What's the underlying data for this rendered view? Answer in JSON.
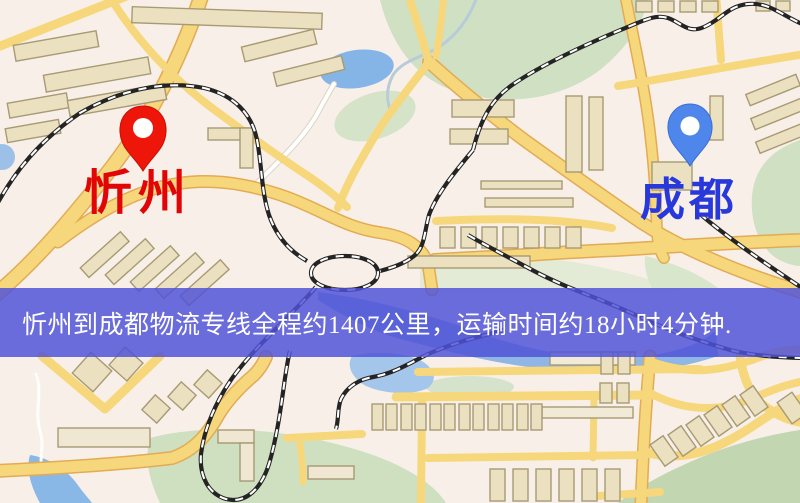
{
  "map": {
    "banner": {
      "text": "忻州到成都物流专线全程约1407公里，运输时间约18小时4分钟.",
      "background_color": "#5052d8",
      "text_color": "#ffffff"
    },
    "origin": {
      "label": "忻州",
      "label_color": "#e10505",
      "pin_color": "#ee1509"
    },
    "destination": {
      "label": "成都",
      "label_color": "#2838da",
      "pin_color": "#4f86ec"
    },
    "route": {
      "distance_text": "约1407公里",
      "duration_text": "约18小时4分钟"
    },
    "map_colors": {
      "land": "#f8f0e8",
      "road_fill": "#f7d77c",
      "road_casing": "#e2ab54",
      "park": "#cfe0c3",
      "water": "#8ab6e6",
      "building_fill": "#ebe1c1",
      "building_stroke": "#a79a74",
      "railway": "#222222"
    }
  }
}
